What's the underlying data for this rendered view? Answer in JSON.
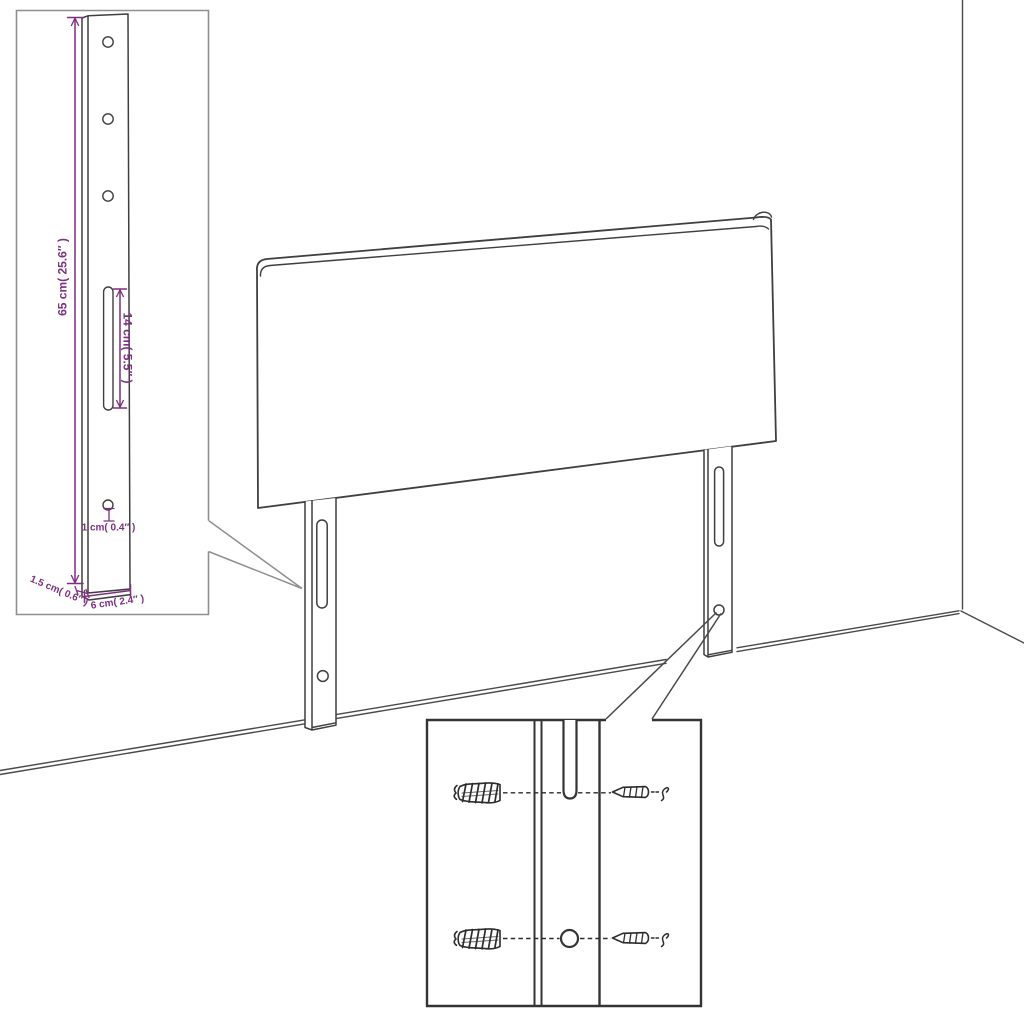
{
  "figure": {
    "kind": "furniture-assembly-line-drawing",
    "subject": "headboard-with-mounting-legs",
    "colors": {
      "line": "#3f3f3f",
      "dimension_text": "#7e2f82",
      "inset_border_light": "#8f8f8f",
      "inset_border_dark": "#343434",
      "background": "#ffffff"
    },
    "dimensions": {
      "leg_height": "65 cm( 25.6″ )",
      "slot_length": "14 cm( 5.5″ )",
      "hole_diameter": "1 cm( 0.4″ )",
      "leg_thickness": "1.5 cm( 0.6″ )",
      "leg_width": "6 cm( 2.4″ )"
    }
  }
}
